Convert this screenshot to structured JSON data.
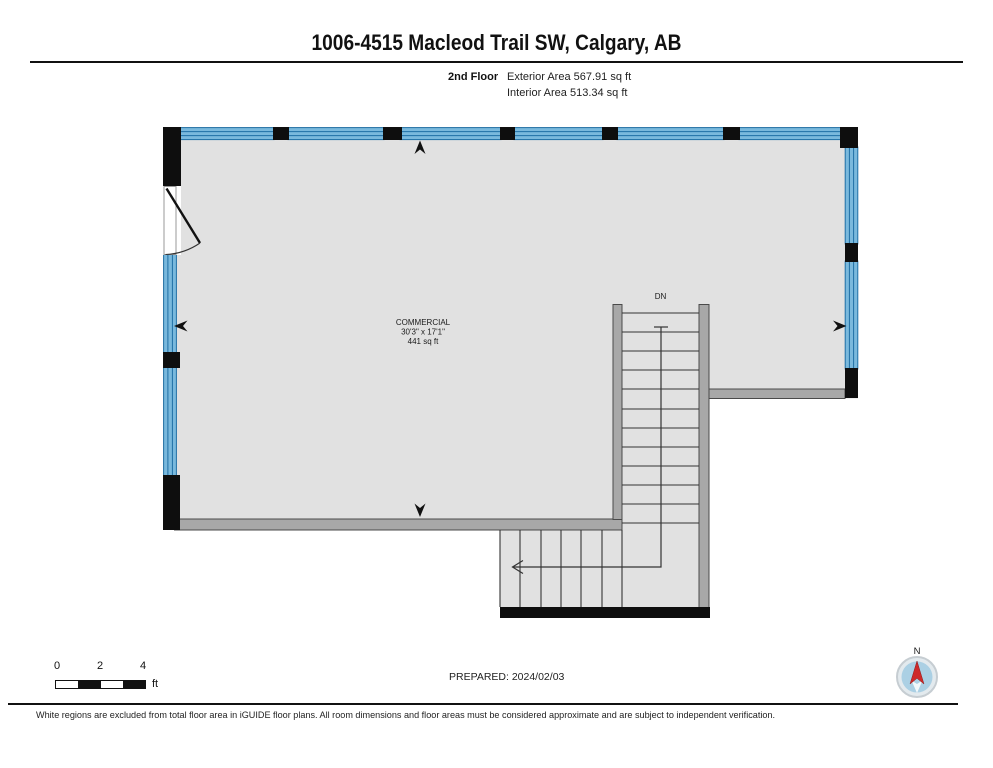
{
  "header": {
    "title": "1006-4515 Macleod Trail SW, Calgary, AB",
    "floor_label": "2nd Floor",
    "exterior_area": "Exterior Area 567.91 sq ft",
    "interior_area": "Interior Area 513.34 sq ft"
  },
  "plan": {
    "room": {
      "name": "COMMERCIAL",
      "dimensions": "30'3\" x 17'1\"",
      "area": "441 sq ft"
    },
    "stair_label": "DN"
  },
  "scale_bar": {
    "labels": [
      "0",
      "2",
      "4"
    ],
    "unit": "ft"
  },
  "footer": {
    "prepared": "PREPARED: 2024/02/03",
    "compass_north": "N",
    "disclaimer": "White regions are excluded from total floor area in iGUIDE floor plans. All room dimensions and floor areas must be considered approximate and are subject to independent verification."
  },
  "colors": {
    "floor_fill": "#e1e1e1",
    "exterior_wall": "#0e0e0e",
    "interior_wall": "#a8a8a8",
    "window_fill": "#7ab9dd",
    "window_line": "#1f6fa5",
    "compass_red": "#ce2a2a",
    "compass_blue": "#abd0e4"
  }
}
